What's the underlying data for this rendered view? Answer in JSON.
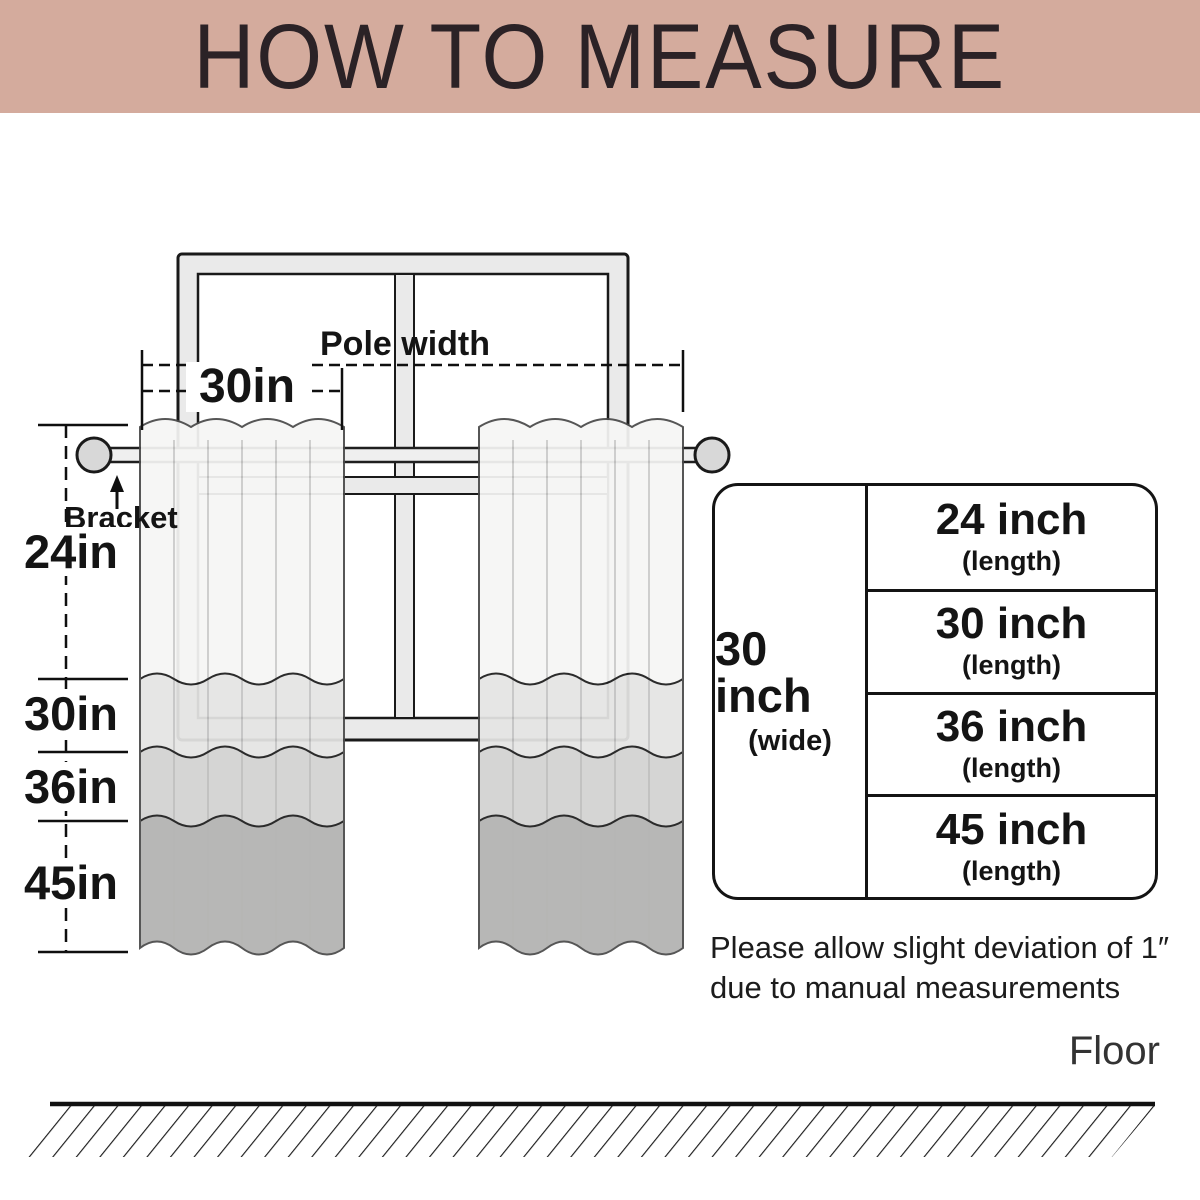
{
  "banner": {
    "title": "HOW TO MEASURE"
  },
  "labels": {
    "pole_width": "Pole width",
    "pole_value": "30in",
    "bracket": "Bracket",
    "len24": "24in",
    "len30": "30in",
    "len36": "36in",
    "len45": "45in"
  },
  "table": {
    "wide": {
      "value": "30 inch",
      "sub": "(wide)"
    },
    "rows": [
      {
        "size": "24 inch",
        "sub": "(length)"
      },
      {
        "size": "30 inch",
        "sub": "(length)"
      },
      {
        "size": "36 inch",
        "sub": "(length)"
      },
      {
        "size": "45 inch",
        "sub": "(length)"
      }
    ]
  },
  "note": {
    "line1": "Please allow slight deviation of 1″",
    "line2": "due to manual measurements"
  },
  "floor": {
    "label": "Floor"
  },
  "colors": {
    "banner-bg": "#d4ab9d",
    "banner-text": "#2b2226",
    "line": "#141414",
    "curtain-b1": "#f6f6f5",
    "curtain-b2": "#e5e5e4",
    "curtain-b3": "#d2d2d1",
    "curtain-b4": "#b2b2b1",
    "frame-fill": "#eaeaea",
    "rod-fill": "#efefef",
    "finial-fill": "#d8d8d8"
  }
}
